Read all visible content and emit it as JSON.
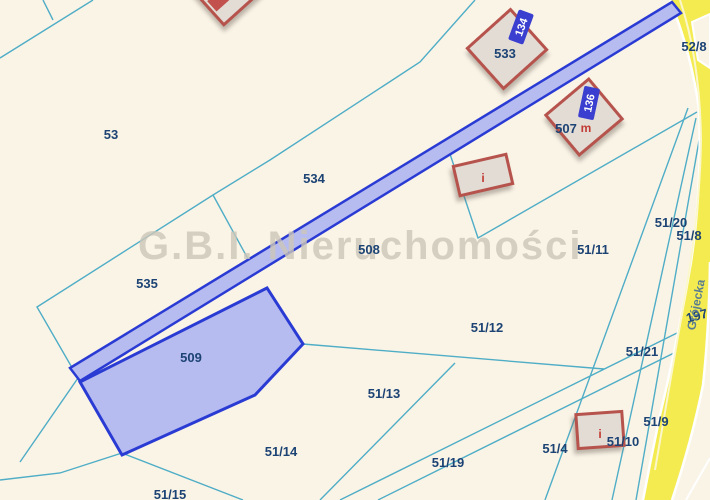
{
  "watermark_text": "G.B.I. Nieruchomości",
  "street": {
    "name": "Grójecka",
    "road_parcel_number": "197"
  },
  "highlighted_parcel": "509",
  "parcel_labels": {
    "p53": "53",
    "p533": "533",
    "p534": "534",
    "p535": "535",
    "p508": "508",
    "p509": "509",
    "p507": "507",
    "p52_8": "52/8",
    "p51_20": "51/20",
    "p51_8": "51/8",
    "p51_11": "51/11",
    "p51_12": "51/12",
    "p51_21": "51/21",
    "p51_13": "51/13",
    "p51_14": "51/14",
    "p51_15": "51/15",
    "p51_19": "51/19",
    "p51_4": "51/4",
    "p51_10": "51/10",
    "p51_9": "51/9"
  },
  "building_tags": {
    "t134": "134",
    "t136": "136"
  },
  "building_letters": {
    "residential_m": "m",
    "other_i_1": "i",
    "other_i_2": "i"
  },
  "colors": {
    "background": "#faf4e7",
    "parcel_line": "#4fadc6",
    "selection_stroke": "#2a3bd4",
    "selection_fill": "#b7bcf0",
    "road_fill": "#f4eb51",
    "building_stroke": "#b5534c",
    "building_fill": "#e3dcd4",
    "label_text": "#1c4374",
    "tag_fill": "#3a3fd0",
    "watermark": "#cdc6b9"
  }
}
